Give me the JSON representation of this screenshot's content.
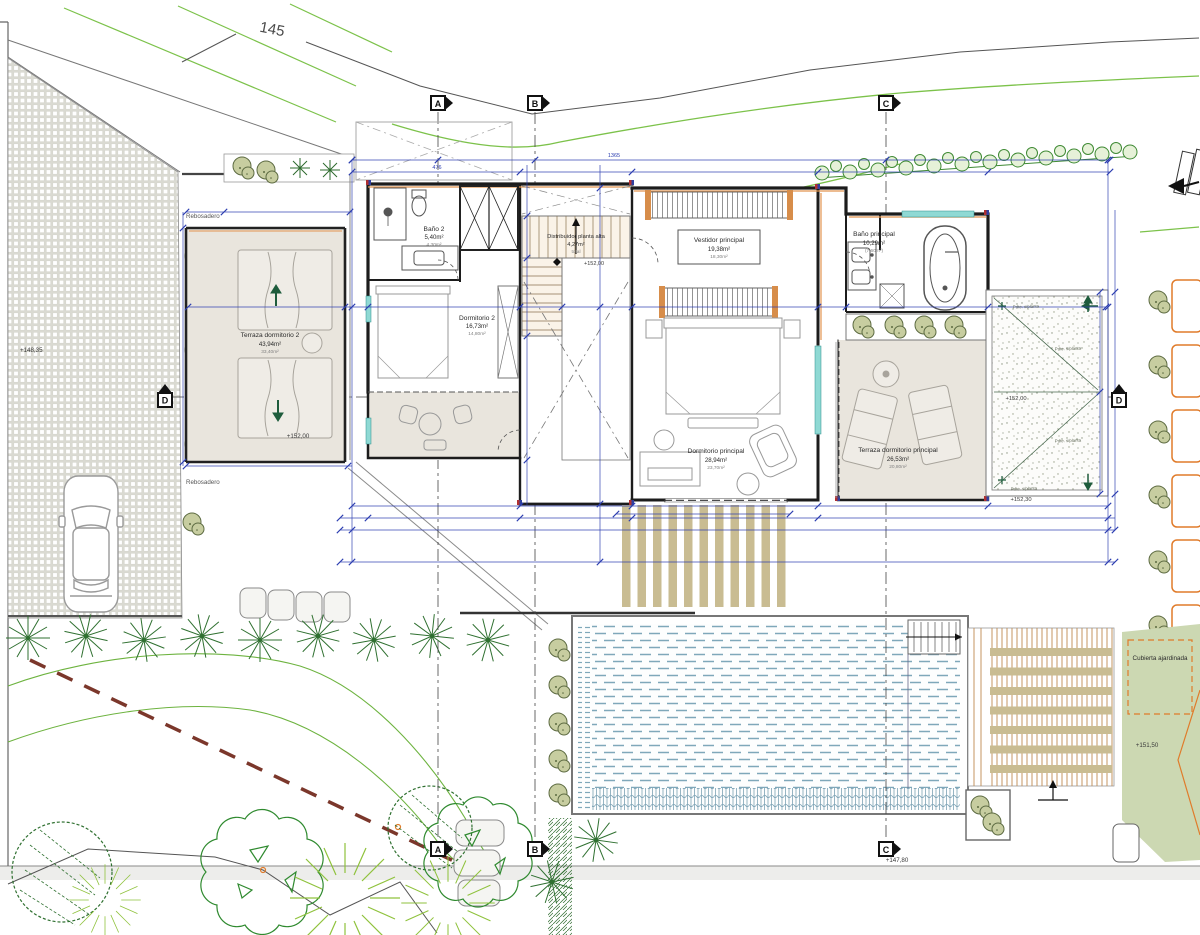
{
  "site": {
    "contour_label": "145",
    "driveway_elevation": "+148,35",
    "overflow_label": "Rebosadero",
    "garden_elevation": "+147,80",
    "green_roof_label": "Cubierta ajardinada",
    "green_roof_elevation": "+151,50"
  },
  "roof": {
    "elevation_center": "+152,00",
    "elevation_edge": "+152,30",
    "slope_note": "Pdte. s/planta"
  },
  "rooms": {
    "terraza2": {
      "name": "Terraza dormitorio 2",
      "area": "43,94m²",
      "net": "33,40m²",
      "elevation": "+152,00"
    },
    "bano2": {
      "name": "Baño 2",
      "area": "5,40m²",
      "net": "4,30m²"
    },
    "dorm2": {
      "name": "Dormitorio 2",
      "area": "16,73m²",
      "net": "14,80m²"
    },
    "distribuidor": {
      "name": "Distribuidor planta alta",
      "area": "4,27m²",
      "note": "total",
      "elevation": "+152,00"
    },
    "vestidor": {
      "name": "Vestidor principal",
      "area": "19,38m²",
      "net": "18,30m²"
    },
    "banop": {
      "name": "Baño principal",
      "area": "10,29m²",
      "net": "(7,60m²)"
    },
    "dormp": {
      "name": "Dormitorio principal",
      "area": "28,94m²",
      "net": "23,70m²"
    },
    "terrazap": {
      "name": "Terraza dormitorio principal",
      "area": "26,53m²",
      "net": "20,80m²"
    }
  },
  "section_markers": {
    "a": "A",
    "b": "B",
    "c": "C",
    "d": "D"
  },
  "dimensions": {
    "top_total": "1365",
    "top_left": "476"
  }
}
